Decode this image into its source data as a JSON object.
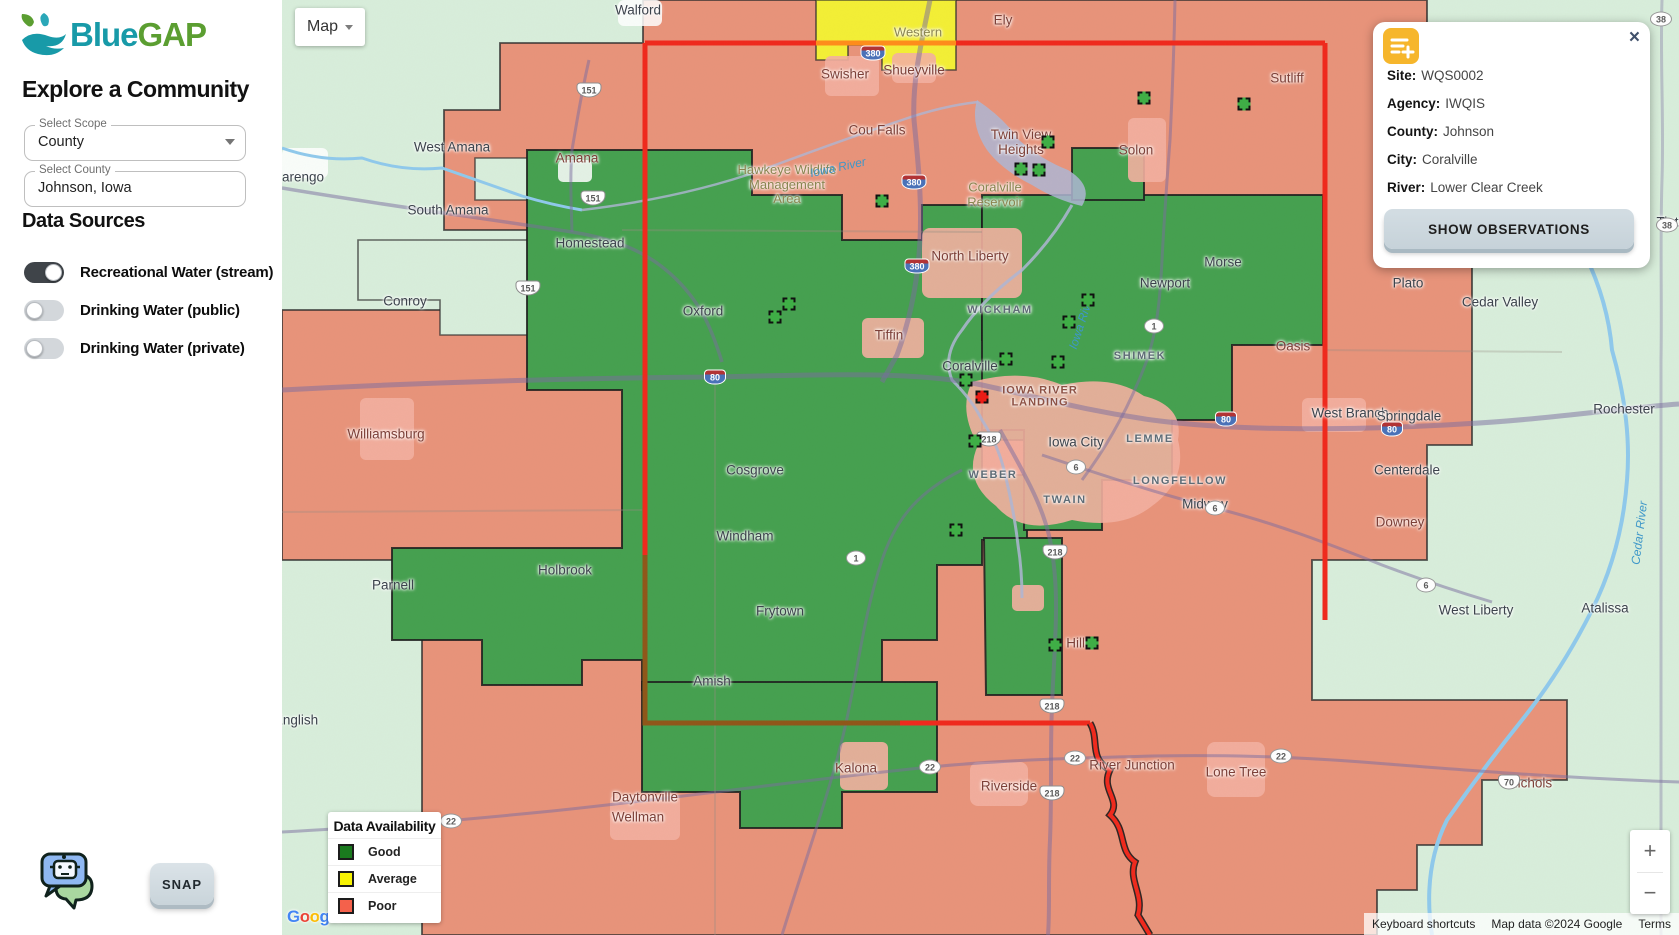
{
  "sidebar": {
    "logo": {
      "blue": "Blue",
      "gap": "GAP"
    },
    "heading": "Explore a Community",
    "scope_field": {
      "label": "Select Scope",
      "value": "County"
    },
    "county_field": {
      "label": "Select County",
      "value": "Johnson, Iowa"
    },
    "data_sources_heading": "Data Sources",
    "toggles": [
      {
        "label": "Recreational Water (stream)",
        "on": true
      },
      {
        "label": "Drinking Water (public)",
        "on": false
      },
      {
        "label": "Drinking Water (private)",
        "on": false
      }
    ],
    "snap_label": "SNAP"
  },
  "map_control": {
    "label": "Map"
  },
  "info_card": {
    "icon": "playlist-add-icon",
    "close": "×",
    "rows": [
      {
        "label": "Site:",
        "value": "WQS0002"
      },
      {
        "label": "Agency:",
        "value": "IWQIS"
      },
      {
        "label": "County:",
        "value": "Johnson"
      },
      {
        "label": "City:",
        "value": "Coralville"
      },
      {
        "label": "River:",
        "value": "Lower Clear Creek"
      }
    ],
    "button": "SHOW OBSERVATIONS"
  },
  "legend": {
    "title": "Data Availability",
    "items": [
      {
        "label": "Good",
        "color": "#1a7a1e"
      },
      {
        "label": "Average",
        "color": "#f7f304"
      },
      {
        "label": "Poor",
        "color": "#f4614b"
      }
    ]
  },
  "zoom_control": {
    "plus": "+",
    "minus": "−"
  },
  "attribution": {
    "items": [
      "Keyboard shortcuts",
      "Map data ©2024 Google",
      "Terms"
    ],
    "logo": "Google"
  },
  "map_colors": {
    "good_region": "#45a04f",
    "poor_region": "#e8937a",
    "average_region": "#f3ef35",
    "no_data": "#d8eedb",
    "city_patch": "#f3b0a0",
    "county_border": "#f0291c"
  },
  "map_labels": [
    {
      "t": "arengo",
      "x": 21,
      "y": 177,
      "c": "city"
    },
    {
      "t": "Walford",
      "x": 356,
      "y": 10,
      "c": "city"
    },
    {
      "t": "Western",
      "x": 636,
      "y": 33,
      "c": "area"
    },
    {
      "t": "Ely",
      "x": 721,
      "y": 20,
      "c": "city red"
    },
    {
      "t": "Swisher",
      "x": 563,
      "y": 74,
      "c": "city red"
    },
    {
      "t": "Shueyville",
      "x": 632,
      "y": 70,
      "c": "city red"
    },
    {
      "t": "Sutliff",
      "x": 1005,
      "y": 78,
      "c": "city red"
    },
    {
      "t": "Cou Falls",
      "x": 595,
      "y": 130,
      "c": "city red"
    },
    {
      "t": "West Amana",
      "x": 170,
      "y": 147,
      "c": "city"
    },
    {
      "t": "Amana",
      "x": 295,
      "y": 158,
      "c": "city red"
    },
    {
      "t": "Twin View\nHeights",
      "x": 739,
      "y": 142,
      "c": "city red"
    },
    {
      "t": "Solon",
      "x": 854,
      "y": 150,
      "c": "city red"
    },
    {
      "t": "Hawkeye Wildlife\nManagement\nArea",
      "x": 505,
      "y": 185,
      "c": "area"
    },
    {
      "t": "Coralville\nReservoir",
      "x": 713,
      "y": 195,
      "c": "area"
    },
    {
      "t": "South Amana",
      "x": 166,
      "y": 210,
      "c": "city"
    },
    {
      "t": "Homestead",
      "x": 308,
      "y": 243,
      "c": "city"
    },
    {
      "t": "North Liberty",
      "x": 688,
      "y": 256,
      "c": "city red"
    },
    {
      "t": "Morse",
      "x": 941,
      "y": 262,
      "c": "city"
    },
    {
      "t": "Newport",
      "x": 883,
      "y": 283,
      "c": "city"
    },
    {
      "t": "Plato",
      "x": 1126,
      "y": 283,
      "c": "city"
    },
    {
      "t": "Cedar Valley",
      "x": 1218,
      "y": 302,
      "c": "city"
    },
    {
      "t": "Conroy",
      "x": 123,
      "y": 301,
      "c": "city"
    },
    {
      "t": "Oxford",
      "x": 421,
      "y": 311,
      "c": "city"
    },
    {
      "t": "WICKHAM",
      "x": 718,
      "y": 310,
      "c": "school"
    },
    {
      "t": "Tiffin",
      "x": 607,
      "y": 335,
      "c": "city red"
    },
    {
      "t": "SHIMEK",
      "x": 858,
      "y": 356,
      "c": "school"
    },
    {
      "t": "Oasis",
      "x": 1011,
      "y": 346,
      "c": "city red"
    },
    {
      "t": "Coralville",
      "x": 688,
      "y": 366,
      "c": "city"
    },
    {
      "t": "IOWA RIVER\nLANDING",
      "x": 758,
      "y": 397,
      "c": "landing"
    },
    {
      "t": "West Branch",
      "x": 1068,
      "y": 413,
      "c": "city"
    },
    {
      "t": "Springdale",
      "x": 1127,
      "y": 416,
      "c": "city"
    },
    {
      "t": "Rochester",
      "x": 1342,
      "y": 409,
      "c": "city"
    },
    {
      "t": "Williamsburg",
      "x": 104,
      "y": 434,
      "c": "city red"
    },
    {
      "t": "Iowa City",
      "x": 794,
      "y": 442,
      "c": "city"
    },
    {
      "t": "LEMME",
      "x": 868,
      "y": 439,
      "c": "school"
    },
    {
      "t": "Centerdale",
      "x": 1125,
      "y": 470,
      "c": "city"
    },
    {
      "t": "Cosgrove",
      "x": 473,
      "y": 470,
      "c": "city"
    },
    {
      "t": "WEBER",
      "x": 711,
      "y": 475,
      "c": "school"
    },
    {
      "t": "LONGFELLOW",
      "x": 898,
      "y": 481,
      "c": "school"
    },
    {
      "t": "TWAIN",
      "x": 783,
      "y": 500,
      "c": "school"
    },
    {
      "t": "Midway",
      "x": 923,
      "y": 504,
      "c": "city"
    },
    {
      "t": "Downey",
      "x": 1118,
      "y": 522,
      "c": "city red"
    },
    {
      "t": "Windham",
      "x": 463,
      "y": 536,
      "c": "city"
    },
    {
      "t": "Holbrook",
      "x": 283,
      "y": 570,
      "c": "city"
    },
    {
      "t": "Parnell",
      "x": 111,
      "y": 585,
      "c": "city"
    },
    {
      "t": "Frytown",
      "x": 498,
      "y": 611,
      "c": "city"
    },
    {
      "t": "West Liberty",
      "x": 1194,
      "y": 610,
      "c": "city"
    },
    {
      "t": "Atalissa",
      "x": 1323,
      "y": 608,
      "c": "city"
    },
    {
      "t": "Hills",
      "x": 797,
      "y": 643,
      "c": "city red"
    },
    {
      "t": "Amish",
      "x": 430,
      "y": 681,
      "c": "city"
    },
    {
      "t": "English",
      "x": 14,
      "y": 720,
      "c": "city"
    },
    {
      "t": "Kalona",
      "x": 574,
      "y": 768,
      "c": "city red"
    },
    {
      "t": "River Junction",
      "x": 850,
      "y": 765,
      "c": "city red"
    },
    {
      "t": "Lone Tree",
      "x": 954,
      "y": 772,
      "c": "city red"
    },
    {
      "t": "Riverside",
      "x": 727,
      "y": 786,
      "c": "city red"
    },
    {
      "t": "Daytonville",
      "x": 363,
      "y": 797,
      "c": "city red"
    },
    {
      "t": "Wellman",
      "x": 356,
      "y": 817,
      "c": "city red"
    },
    {
      "t": "Nichols",
      "x": 1248,
      "y": 783,
      "c": "city red"
    },
    {
      "t": "Tipton",
      "x": 1393,
      "y": 222,
      "c": "city"
    },
    {
      "t": "Iowa River",
      "x": 556,
      "y": 168,
      "c": "water",
      "r": -12
    },
    {
      "t": "Iowa River",
      "x": 800,
      "y": 322,
      "c": "water",
      "r": -72
    },
    {
      "t": "Cedar River",
      "x": 1358,
      "y": 533,
      "c": "water",
      "r": -83
    }
  ],
  "road_shields": [
    {
      "n": "151",
      "k": "us",
      "x": 307,
      "y": 90
    },
    {
      "n": "151",
      "k": "us",
      "x": 311,
      "y": 198
    },
    {
      "n": "151",
      "k": "us",
      "x": 246,
      "y": 288
    },
    {
      "n": "380",
      "k": "interstate",
      "x": 591,
      "y": 53
    },
    {
      "n": "380",
      "k": "interstate",
      "x": 632,
      "y": 182
    },
    {
      "n": "380",
      "k": "interstate",
      "x": 635,
      "y": 266
    },
    {
      "n": "80",
      "k": "interstate",
      "x": 433,
      "y": 377
    },
    {
      "n": "80",
      "k": "interstate",
      "x": 944,
      "y": 419
    },
    {
      "n": "80",
      "k": "interstate",
      "x": 1110,
      "y": 429
    },
    {
      "n": "218",
      "k": "us",
      "x": 707,
      "y": 439
    },
    {
      "n": "218",
      "k": "us",
      "x": 773,
      "y": 552
    },
    {
      "n": "218",
      "k": "us",
      "x": 770,
      "y": 706
    },
    {
      "n": "218",
      "k": "us",
      "x": 770,
      "y": 793
    },
    {
      "n": "1",
      "k": "state",
      "x": 872,
      "y": 326
    },
    {
      "n": "1",
      "k": "state",
      "x": 574,
      "y": 558
    },
    {
      "n": "6",
      "k": "state",
      "x": 794,
      "y": 467
    },
    {
      "n": "6",
      "k": "state",
      "x": 933,
      "y": 508
    },
    {
      "n": "6",
      "k": "state",
      "x": 1144,
      "y": 585
    },
    {
      "n": "22",
      "k": "state",
      "x": 169,
      "y": 821
    },
    {
      "n": "22",
      "k": "state",
      "x": 648,
      "y": 767
    },
    {
      "n": "22",
      "k": "state",
      "x": 793,
      "y": 758
    },
    {
      "n": "22",
      "k": "state",
      "x": 999,
      "y": 756
    },
    {
      "n": "70",
      "k": "us",
      "x": 1227,
      "y": 782
    },
    {
      "n": "38",
      "k": "state",
      "x": 1379,
      "y": 19
    },
    {
      "n": "38",
      "k": "state",
      "x": 1385,
      "y": 225
    }
  ],
  "site_markers": {
    "green": [
      [
        600,
        201
      ],
      [
        739,
        169
      ],
      [
        757,
        170
      ],
      [
        766,
        142
      ],
      [
        862,
        98
      ],
      [
        962,
        104
      ],
      [
        507,
        304
      ],
      [
        493,
        317
      ],
      [
        806,
        300
      ],
      [
        787,
        322
      ],
      [
        776,
        362
      ],
      [
        724,
        359
      ],
      [
        684,
        380
      ],
      [
        693,
        441
      ],
      [
        674,
        530
      ],
      [
        773,
        645
      ],
      [
        810,
        643
      ]
    ],
    "selected_red": [
      [
        700,
        397
      ]
    ]
  }
}
